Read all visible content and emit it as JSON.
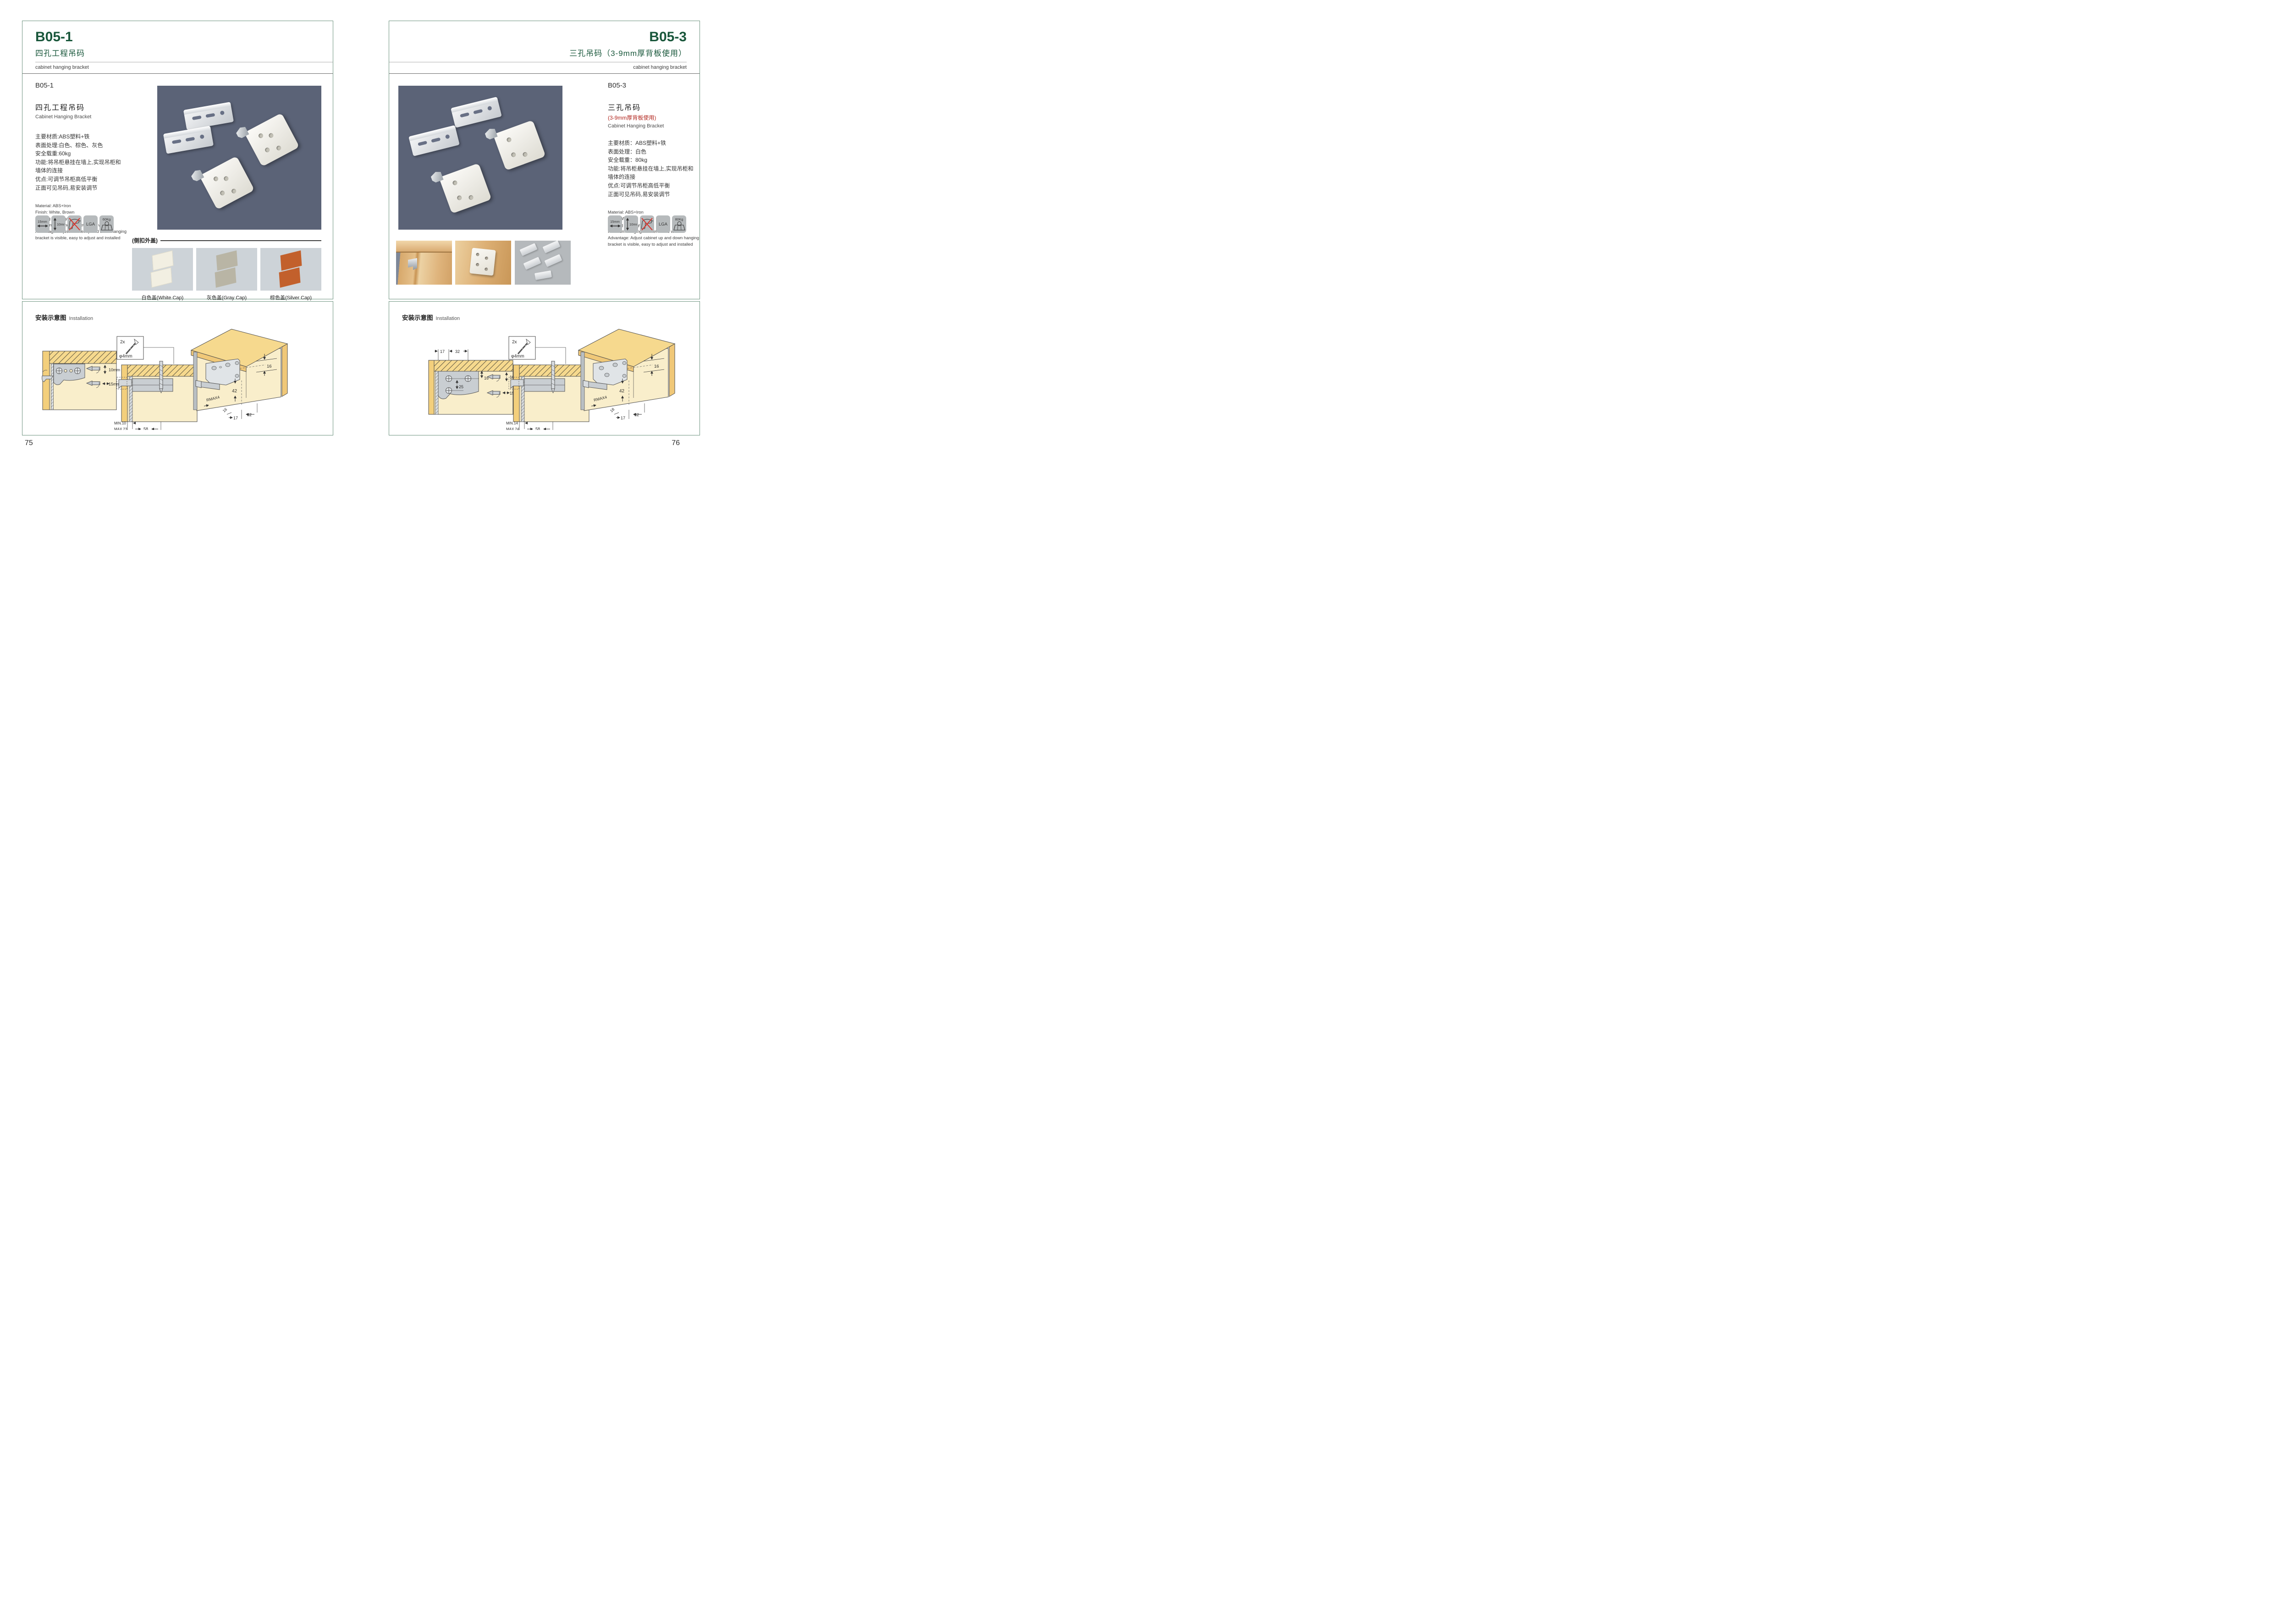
{
  "left": {
    "header": {
      "code": "B05-1",
      "title_cn": "四孔工程吊码",
      "subtitle_en": "cabinet hanging bracket"
    },
    "product": {
      "code": "B05-1",
      "name_cn": "四孔工程吊码",
      "name_en": "Cabinet Hanging Bracket"
    },
    "specs_cn": [
      "主要材质:ABS塑料+铁",
      "表面处理:白色、棕色、灰色",
      "安全载重:60kg",
      "功能:将吊柜悬挂在墙上,实现吊柜和",
      "墙体的连接",
      "优点:可调节吊柜高低平衡",
      "正面可见吊码,易安装调节"
    ],
    "specs_en": [
      "Material: ABS+Iron",
      "Finish: White, Brown",
      "Loading capacity: 60kg",
      "Function: hanging cabinet on the wall",
      "Advantage: Adjust cabinet up and down hanging",
      "bracket is visible, easy to adjust and installed"
    ],
    "icons": [
      {
        "label": "15mm"
      },
      {
        "label": "10mm"
      },
      {
        "label": ""
      },
      {
        "label": "LGA"
      },
      {
        "label": "60Kg"
      }
    ],
    "caps": {
      "section_label": "(侧扣外盖)",
      "items": [
        "白色盖(White Cap)",
        "灰色盖(Gray Cap)",
        "棕色盖(Silver Cap)"
      ]
    },
    "installation": {
      "title_cn": "安装示意图",
      "title_en": "Installation",
      "d1": {
        "top": "10mm",
        "bottom": "15mm"
      },
      "d2": {
        "count": "2x",
        "dia": "φ4mm",
        "h": "18",
        "min": "MIN.10",
        "max": "MAX.23",
        "w": "58"
      },
      "d3": {
        "a": "16",
        "b": "42",
        "r": "RMAX4",
        "c": "16",
        "d": "17",
        "e": "32"
      }
    },
    "page_number": "75"
  },
  "right": {
    "header": {
      "code": "B05-3",
      "title_cn": "三孔吊码（3-9mm厚背板使用）",
      "subtitle_en": "cabinet hanging bracket"
    },
    "product": {
      "code": "B05-3",
      "name_cn": "三孔吊码",
      "name_note": "(3-9mm厚背板使用)",
      "name_en": "Cabinet Hanging Bracket"
    },
    "specs_cn": [
      "主要材质：ABS塑料+铁",
      "表面处理：白色",
      "安全载重：80kg",
      "功能:将吊柜悬挂在墙上,实现吊柜和",
      "墙体的连接",
      "优点:可调节吊柜高低平衡",
      "正面可见吊码,易安装调节"
    ],
    "specs_en": [
      "Material: ABS+Iron",
      "Finish: White",
      "Loading capacity: 80kg",
      "Function: hanging cabinet on the wall",
      "Advantage: Adjust cabinet up and down hanging",
      "bracket is visible, easy to adjust and installed"
    ],
    "icons": [
      {
        "label": "15mm"
      },
      {
        "label": "10mm"
      },
      {
        "label": ""
      },
      {
        "label": "LGA"
      },
      {
        "label": "80Kg"
      }
    ],
    "installation": {
      "title_cn": "安装示意图",
      "title_en": "Installation",
      "d1": {
        "t1": "17",
        "t2": "32",
        "s1": "16",
        "s2": "25",
        "top": "10mm",
        "bottom": "15mm"
      },
      "d2": {
        "count": "2x",
        "dia": "φ4mm",
        "h": "18",
        "min": "MIN.14",
        "max": "MAX.24",
        "w": "58"
      },
      "d3": {
        "a": "16",
        "b": "42",
        "r": "RMAX4",
        "c": "18",
        "d": "17",
        "e": "32"
      }
    },
    "page_number": "76"
  }
}
